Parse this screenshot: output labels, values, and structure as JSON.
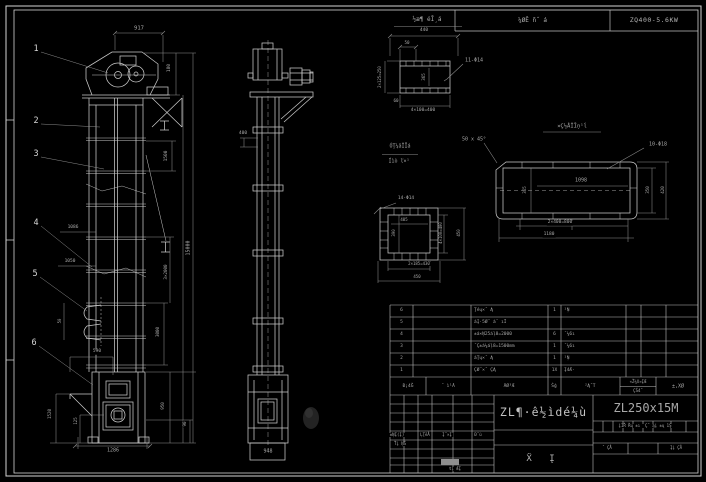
{
  "meta": {
    "background": "#000000",
    "line_color": "#c9c9c9",
    "dim_color": "#8d8d8d",
    "text_color": "#a9a9a9"
  },
  "header": {
    "material_label": "¼ØĒ ñ˝ á",
    "motor_model": "ZQ400-5.6KW"
  },
  "title_block": {
    "product_title": "ZL¶·ê½ìdé¼ù",
    "drawing_number": "ZL250x15M",
    "sheet_label": "Ẍ  Į"
  },
  "parts_table": {
    "header": {
      "no": "Đ¡4Ğ",
      "code": "˝ ì¹Ã",
      "name": "ÃØ³Æ",
      "qty": "Ŝģ",
      "material": "²Ą˝T",
      "weight_top": "«Ž¼X¤ĮÆ",
      "weight_bottom": "ÇŠ4˝",
      "remark": "±,XØ"
    },
    "rows": [
      {
        "no": "6",
        "code": "",
        "name": "Ţéų×˝ Ą",
        "qty": "1",
        "material": "¹Ņ"
      },
      {
        "no": "5",
        "code": "",
        "name": "áĮ·5Ø˝ á˝ ıİ",
        "qty": "",
        "material": ""
      },
      {
        "no": "4",
        "code": "",
        "name": "±á×Ņ25áļ8=2000",
        "qty": "6",
        "material": "˝¼6ı"
      },
      {
        "no": "3",
        "code": "",
        "name": "˝Ç±á¼áļ8=1500mm",
        "qty": "1",
        "material": "˝¼6ı"
      },
      {
        "no": "2",
        "code": "",
        "name": "áŢų×˝ Ą",
        "qty": "1",
        "material": "¹Ņ"
      },
      {
        "no": "1",
        "code": "",
        "name": "ÇØ˝×˝ ÇĄ",
        "qty": "1X",
        "material": "Į4Æ·"
      }
    ]
  },
  "balloons": [
    {
      "t": "1",
      "x": 36,
      "y": 49
    },
    {
      "t": "2",
      "x": 36,
      "y": 121
    },
    {
      "t": "3",
      "x": 36,
      "y": 154
    },
    {
      "t": "4",
      "x": 36,
      "y": 223
    },
    {
      "t": "5",
      "x": 35,
      "y": 274
    },
    {
      "t": "6",
      "x": 34,
      "y": 343
    }
  ],
  "labels": [
    {
      "n": "dim-917",
      "t": "917",
      "x": 139,
      "y": 29,
      "s": 5.5
    },
    {
      "n": "dim-180",
      "t": "180",
      "x": 170,
      "y": 68,
      "r": 1,
      "s": 4.5
    },
    {
      "n": "dim-1500",
      "t": "1500",
      "x": 167,
      "y": 156,
      "r": 1,
      "s": 4.5
    },
    {
      "n": "dim-15000",
      "t": "15000",
      "x": 189,
      "y": 248,
      "r": 1,
      "s": 5
    },
    {
      "n": "dim-3x2000",
      "t": "3×2000",
      "x": 166,
      "y": 272,
      "r": 1,
      "s": 4.2
    },
    {
      "n": "dim-3000",
      "t": "3000",
      "x": 158,
      "y": 332,
      "r": 1,
      "s": 4.2
    },
    {
      "n": "dim-1086",
      "t": "1086",
      "x": 73,
      "y": 228,
      "s": 4.5
    },
    {
      "n": "dim-1050",
      "t": "1050",
      "x": 70,
      "y": 262,
      "s": 4.5
    },
    {
      "n": "dim-50-bucket",
      "t": "50",
      "x": 60,
      "y": 321,
      "r": 1,
      "s": 4
    },
    {
      "n": "dim-590",
      "t": "590",
      "x": 97,
      "y": 352,
      "s": 4.5
    },
    {
      "n": "dim-1520",
      "t": "1520",
      "x": 50,
      "y": 414,
      "r": 1,
      "s": 4.2
    },
    {
      "n": "dim-125",
      "t": "125",
      "x": 76,
      "y": 421,
      "r": 1,
      "s": 4
    },
    {
      "n": "dim-950",
      "t": "950",
      "x": 163,
      "y": 406,
      "r": 1,
      "s": 4.2
    },
    {
      "n": "dim-90",
      "t": "90",
      "x": 185,
      "y": 424,
      "r": 1,
      "s": 4.2
    },
    {
      "n": "dim-1286",
      "t": "1286",
      "x": 113,
      "y": 451,
      "s": 5
    },
    {
      "n": "dim-400-side",
      "t": "400",
      "x": 243,
      "y": 134,
      "s": 4.5
    },
    {
      "n": "dim-948",
      "t": "948",
      "x": 268,
      "y": 452,
      "s": 5
    },
    {
      "n": "detail-a-title",
      "t": "½æ¶ éĪ¸á",
      "x": 427,
      "y": 20,
      "s": 6
    },
    {
      "n": "dim-440",
      "t": "440",
      "x": 424,
      "y": 31,
      "s": 4.5
    },
    {
      "n": "dim-50-a",
      "t": "50",
      "x": 407,
      "y": 43,
      "s": 4.2
    },
    {
      "n": "dim-2x125",
      "t": "2×125=250",
      "x": 380,
      "y": 77,
      "r": 1,
      "s": 4
    },
    {
      "n": "dim-365-a",
      "t": "365",
      "x": 424,
      "y": 77,
      "r": 1,
      "s": 4.2
    },
    {
      "n": "hole-label-a",
      "t": "11-Φ14",
      "x": 474,
      "y": 61,
      "s": 5
    },
    {
      "n": "dim-60",
      "t": "60",
      "x": 396,
      "y": 101,
      "s": 4.2
    },
    {
      "n": "dim-4x100-a",
      "t": "4×100=400",
      "x": 423,
      "y": 111,
      "s": 4.5
    },
    {
      "n": "detail-b-title",
      "t": "¤Ç½ÅÎĪņ¹ĺ",
      "x": 572,
      "y": 127,
      "s": 5.5
    },
    {
      "n": "chamfer-note",
      "t": "50 x 45°",
      "x": 474,
      "y": 140,
      "s": 5
    },
    {
      "n": "hole-label-b",
      "t": "10-Φ18",
      "x": 658,
      "y": 145,
      "s": 5
    },
    {
      "n": "dim-1098",
      "t": "1098",
      "x": 581,
      "y": 181,
      "s": 5
    },
    {
      "n": "dim-365-b",
      "t": "365",
      "x": 525,
      "y": 190,
      "r": 1,
      "s": 4.2
    },
    {
      "n": "dim-2x400",
      "t": "2×400=800",
      "x": 560,
      "y": 223,
      "s": 4.5
    },
    {
      "n": "dim-1180",
      "t": "1180",
      "x": 549,
      "y": 235,
      "s": 4.5
    },
    {
      "n": "dim-350",
      "t": "350",
      "x": 648,
      "y": 190,
      "r": 1,
      "s": 4.2
    },
    {
      "n": "dim-420",
      "t": "420",
      "x": 663,
      "y": 190,
      "r": 1,
      "s": 4.2
    },
    {
      "n": "detail-c-title-1",
      "t": "ÓŢ¼ăÎĪá",
      "x": 400,
      "y": 147,
      "s": 5
    },
    {
      "n": "detail-c-title-2",
      "t": "Íìò ľ×¹",
      "x": 399,
      "y": 162,
      "s": 5
    },
    {
      "n": "hole-label-c",
      "t": "14-Φ14",
      "x": 406,
      "y": 199,
      "s": 4.5
    },
    {
      "n": "dim-405",
      "t": "405",
      "x": 404,
      "y": 220,
      "s": 4
    },
    {
      "n": "dim-390",
      "t": "390",
      "x": 394,
      "y": 233,
      "r": 1,
      "s": 4
    },
    {
      "n": "dim-4x100-c",
      "t": "4×100=400",
      "x": 441,
      "y": 233,
      "r": 1,
      "s": 4
    },
    {
      "n": "dim-450-r",
      "t": "450",
      "x": 459,
      "y": 233,
      "r": 1,
      "s": 4
    },
    {
      "n": "dim-2x185",
      "t": "2×185=430",
      "x": 419,
      "y": 264,
      "s": 4
    },
    {
      "n": "dim-450-b",
      "t": "450",
      "x": 417,
      "y": 277,
      "s": 4
    },
    {
      "n": "parts-header-no",
      "t": "Đ¡4Ğ",
      "x": 408,
      "y": 387,
      "s": 4.5
    },
    {
      "n": "parts-header-code",
      "t": "˝ ì¹Ã",
      "x": 448,
      "y": 387,
      "s": 4.5
    },
    {
      "n": "parts-header-name",
      "t": "ÃØ³Æ",
      "x": 509,
      "y": 387,
      "s": 4.5
    },
    {
      "n": "parts-header-qty",
      "t": "Ŝģ",
      "x": 554,
      "y": 387,
      "s": 4.5
    },
    {
      "n": "parts-header-material",
      "t": "²Ą˝T",
      "x": 590,
      "y": 387,
      "s": 4.5
    },
    {
      "n": "parts-header-weight-top",
      "t": "«Ž¼X¤ĮÆ",
      "x": 638,
      "y": 382,
      "s": 4
    },
    {
      "n": "parts-header-weight-bottom",
      "t": "ÇŠ4˝",
      "x": 638,
      "y": 391,
      "s": 4
    },
    {
      "n": "parts-header-remark",
      "t": "±,XØ",
      "x": 678,
      "y": 387,
      "s": 5
    },
    {
      "n": "sig-col-1",
      "t": "±ŅĮ(Į)",
      "x": 397,
      "y": 435,
      "s": 4
    },
    {
      "n": "sig-col-2",
      "t": "ĻŢēÅ",
      "x": 425,
      "y": 435,
      "s": 4
    },
    {
      "n": "sig-col-3",
      "t": "Į˝×Į",
      "x": 447,
      "y": 435,
      "s": 4
    },
    {
      "n": "sig-col-4",
      "t": "Đ˝ù",
      "x": 478,
      "y": 435,
      "s": 4
    },
    {
      "n": "sig-drawn",
      "t": "Ťį ŅŠ",
      "x": 400,
      "y": 444,
      "s": 4
    },
    {
      "n": "sig-approved",
      "t": "ŧį ÆĮ",
      "x": 455,
      "y": 469,
      "s": 4
    },
    {
      "n": "mini-table-header",
      "t": "į1Ř Řų ±ı ׊ Ç˝ ąį ±ų 1Ş",
      "x": 645,
      "y": 426,
      "s": 4
    },
    {
      "n": "sheet-cell-left",
      "t": "˝ ÇÅ",
      "x": 607,
      "y": 448,
      "s": 4
    },
    {
      "n": "sheet-cell-right",
      "t": "Įį ÇÅ",
      "x": 676,
      "y": 448,
      "s": 4
    }
  ]
}
